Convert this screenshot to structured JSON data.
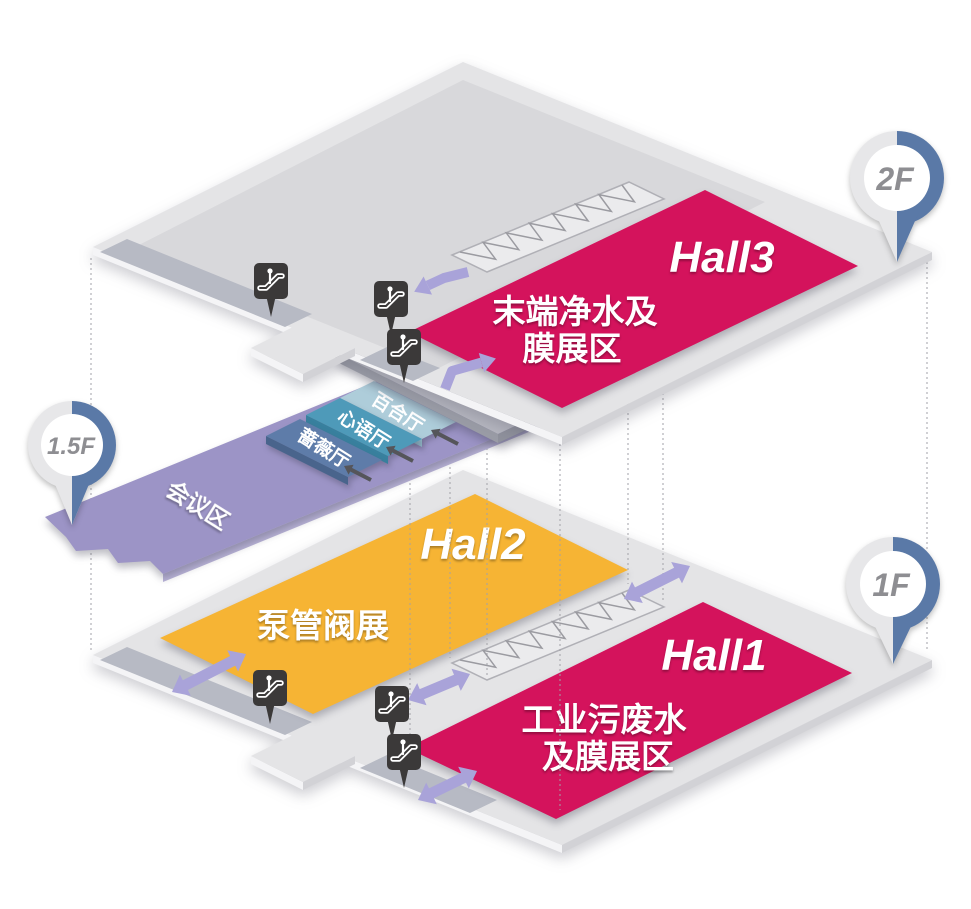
{
  "floors": {
    "floor_2f": {
      "pin_label": "2F",
      "hall3": {
        "name": "Hall3",
        "label_line1": "末端净水及",
        "label_line2": "膜展区"
      }
    },
    "floor_1_5f": {
      "pin_label": "1.5F",
      "conference_label": "会议区",
      "rooms": [
        {
          "label": "百合厅"
        },
        {
          "label": "心语厅"
        },
        {
          "label": "蔷薇厅"
        }
      ]
    },
    "floor_1f": {
      "pin_label": "1F",
      "hall2": {
        "name": "Hall2",
        "label_line1": "泵管阀展"
      },
      "hall1": {
        "name": "Hall1",
        "label_line1": "工业污废水",
        "label_line2": "及膜展区"
      }
    }
  },
  "icons": {
    "escalator_sign": "escalator-icon",
    "floor_pin": "floor-pin-icon",
    "flow_double_arrow": "double-arrow-icon",
    "flow_bent_arrow": "bent-arrow-icon",
    "entry_arrow": "entry-arrow-icon"
  },
  "colors": {
    "hall_red": "#d4135c",
    "hall_yellow": "#f6b434",
    "conference_purple": "#9c94c6",
    "room_baihe_blue": "#aecdda",
    "room_xinyu_teal": "#4e9ab9",
    "room_qiangwei_slate": "#5e7ca9",
    "pin_blue": "#5a79a7",
    "arrow_lavender": "#a9a3d9",
    "floor_gray": "#e4e4e6",
    "escalator_sign_black": "#3b3939"
  }
}
